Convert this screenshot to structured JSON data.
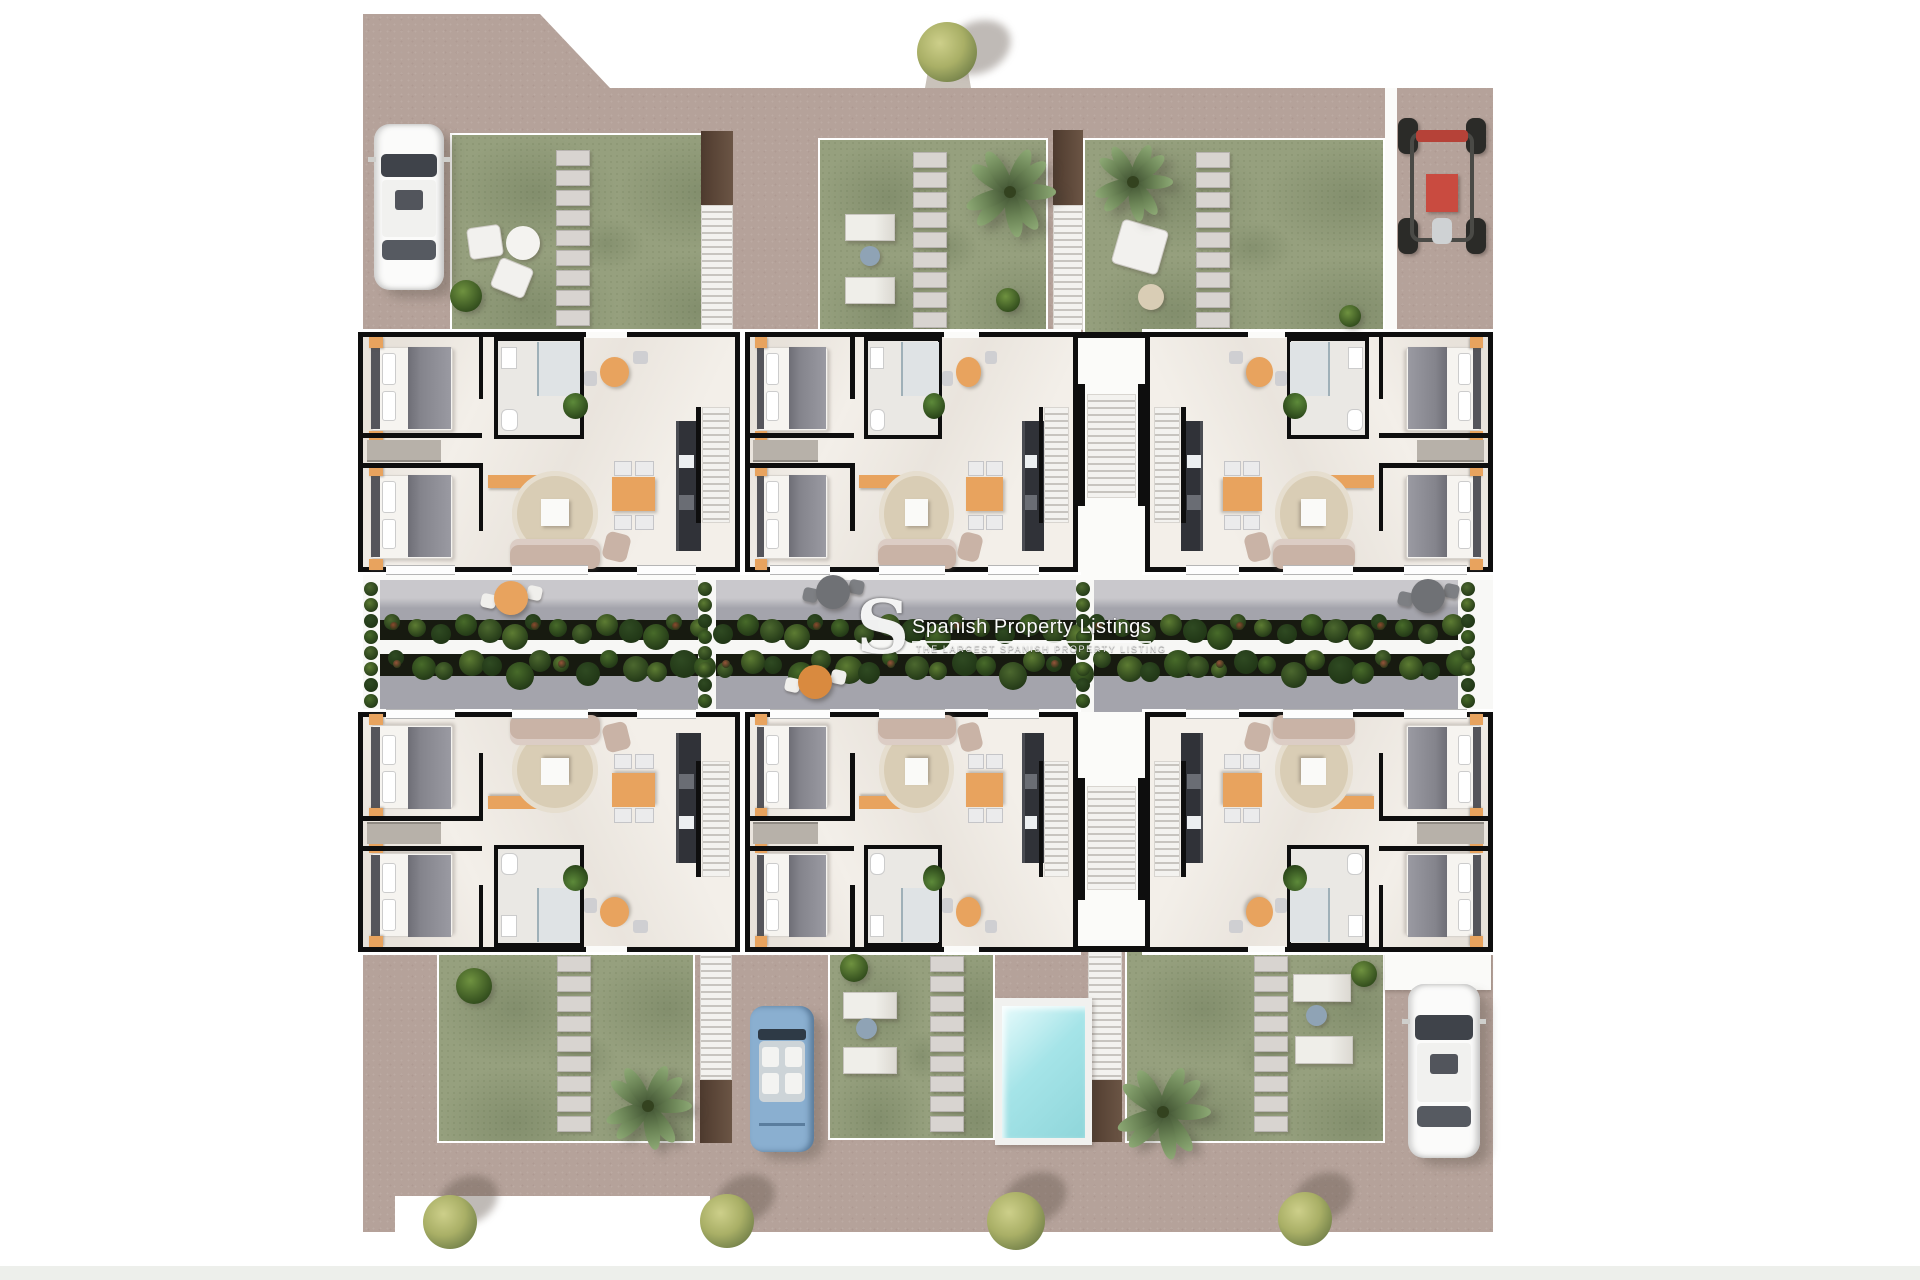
{
  "watermark": {
    "logo_letter": "S",
    "title": "Spanish Property Listings",
    "subtitle": "THE LARGEST SPANISH PROPERTY LISTING"
  },
  "colors": {
    "pavement": "#b5a29a",
    "lawn": "#96a07e",
    "paver": "#d8d4d0",
    "terrace": "#a4a4ac",
    "terrace_light": "#c9c8cc",
    "walkway": "#f7f7f5",
    "planter": "#171a10",
    "plant": "#4c682f",
    "plant_light": "#6f9240",
    "wall": "#0e0e0e",
    "floor": "#f3efe9",
    "rug": "#d9cdb5",
    "sofa": "#c9b3a6",
    "bed_blanket": "#84848c",
    "bed_sheet": "#f6f4f0",
    "headboard": "#55555b",
    "accent_orange": "#e8a35e",
    "kitchen_dark": "#303238",
    "stair_brown": "#5a4537",
    "pool_water": "#a5e4e8",
    "pool_rim": "#f1f1ef",
    "car_white": "#fbfbfa",
    "car_blue": "#8aafd0",
    "buggy_red": "#c94b40",
    "tree_leaf": "#a9b05f",
    "tree_leaf_dark": "#6f7f42",
    "palm_leaf": "#6b8456",
    "shadow": "rgba(90,80,70,0.35)"
  }
}
